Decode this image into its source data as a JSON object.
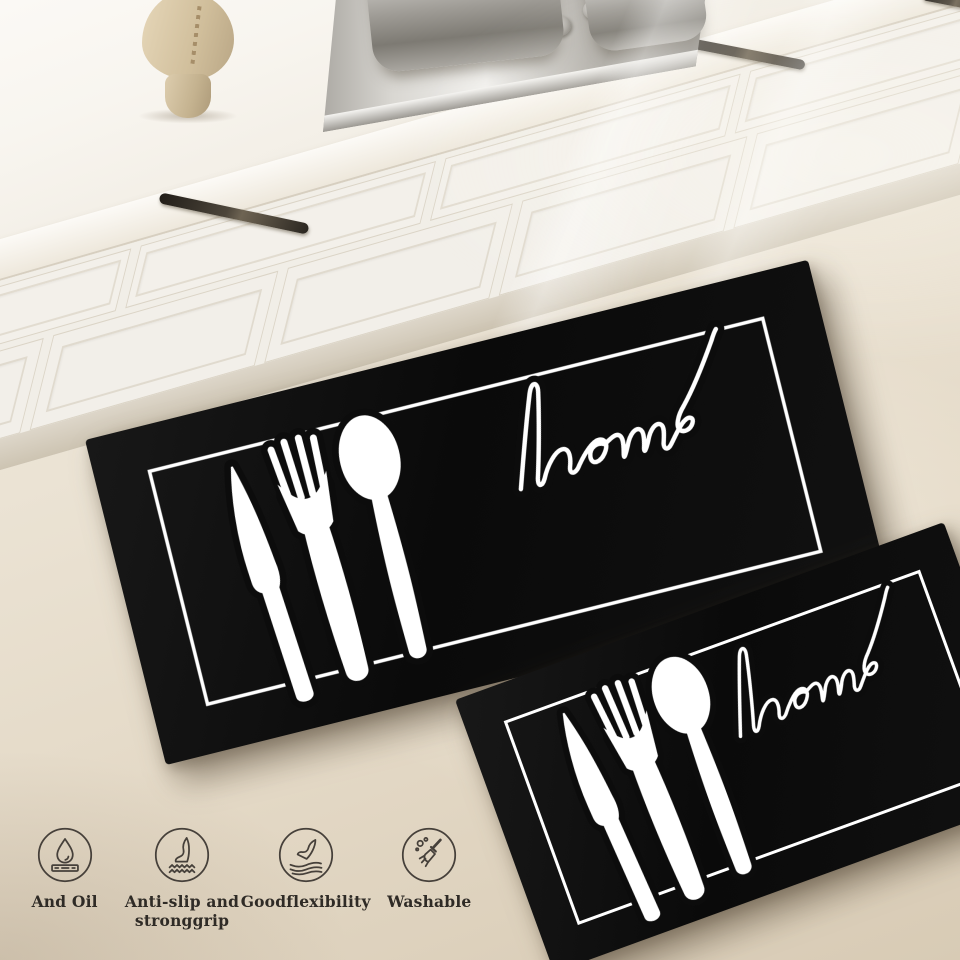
{
  "product_scene": {
    "mats": {
      "large": {
        "word": "home"
      },
      "small": {
        "word": "home"
      }
    },
    "features": [
      {
        "icon": "waterproof-oil-drop-icon",
        "label": "And Oil"
      },
      {
        "icon": "anti-slip-foot-icon",
        "label": "Anti-slip and\nstronggrip"
      },
      {
        "icon": "flexibility-foot-icon",
        "label": "Goodflexibility"
      },
      {
        "icon": "washable-brush-icon",
        "label": "Washable"
      }
    ],
    "colors": {
      "mat_black": "#0c0c0c",
      "print_white": "#ffffff",
      "floor_beige": "#e7dfd1",
      "cabinet_white": "#f2efe8",
      "icon_line": "#46403a",
      "label_text": "#2f2b26",
      "knob_accent_red": "#b23a32",
      "steel_gray": "#b5b2ad",
      "handle_dark": "#3a332b",
      "vase_beige": "#d5c3a2"
    }
  }
}
